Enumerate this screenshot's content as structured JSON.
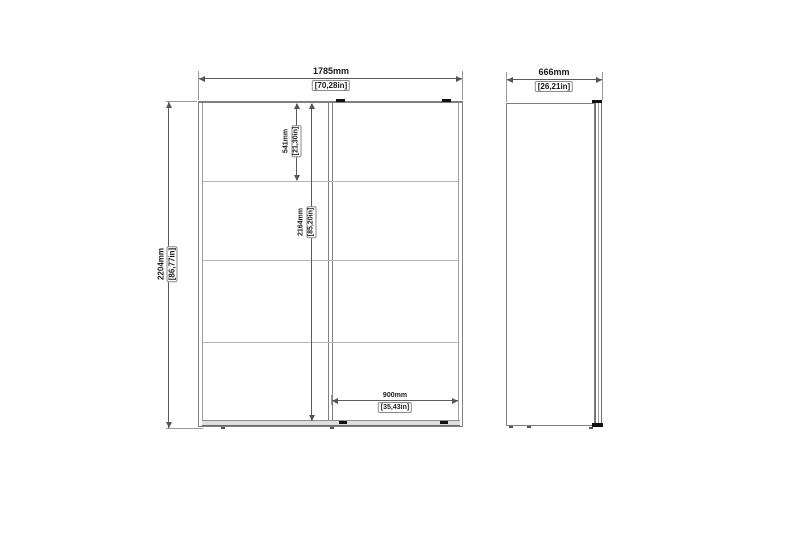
{
  "drawing": {
    "type": "furniture-dimension-diagram",
    "views": {
      "front": "front-view",
      "side": "side-view"
    },
    "colors": {
      "background": "#ffffff",
      "outline": "#7f7f7f",
      "divider": "#b5b5b5",
      "dimension_line": "#5c5c5c",
      "text": "#1a1a1a",
      "detail_mark": "#111111",
      "plinth_fill": "#dedede"
    }
  },
  "dims": {
    "front_width": {
      "mm": "1785mm",
      "in": "[70,28in]"
    },
    "front_height": {
      "mm": "2204mm",
      "in": "[86,77in]"
    },
    "top_section": {
      "mm": "541mm",
      "in": "[21,30in]"
    },
    "interior_height": {
      "mm": "2164mm",
      "in": "[85,20in]"
    },
    "door_width": {
      "mm": "900mm",
      "in": "[35,43in]"
    },
    "side_depth": {
      "mm": "666mm",
      "in": "[26,21in]"
    }
  }
}
